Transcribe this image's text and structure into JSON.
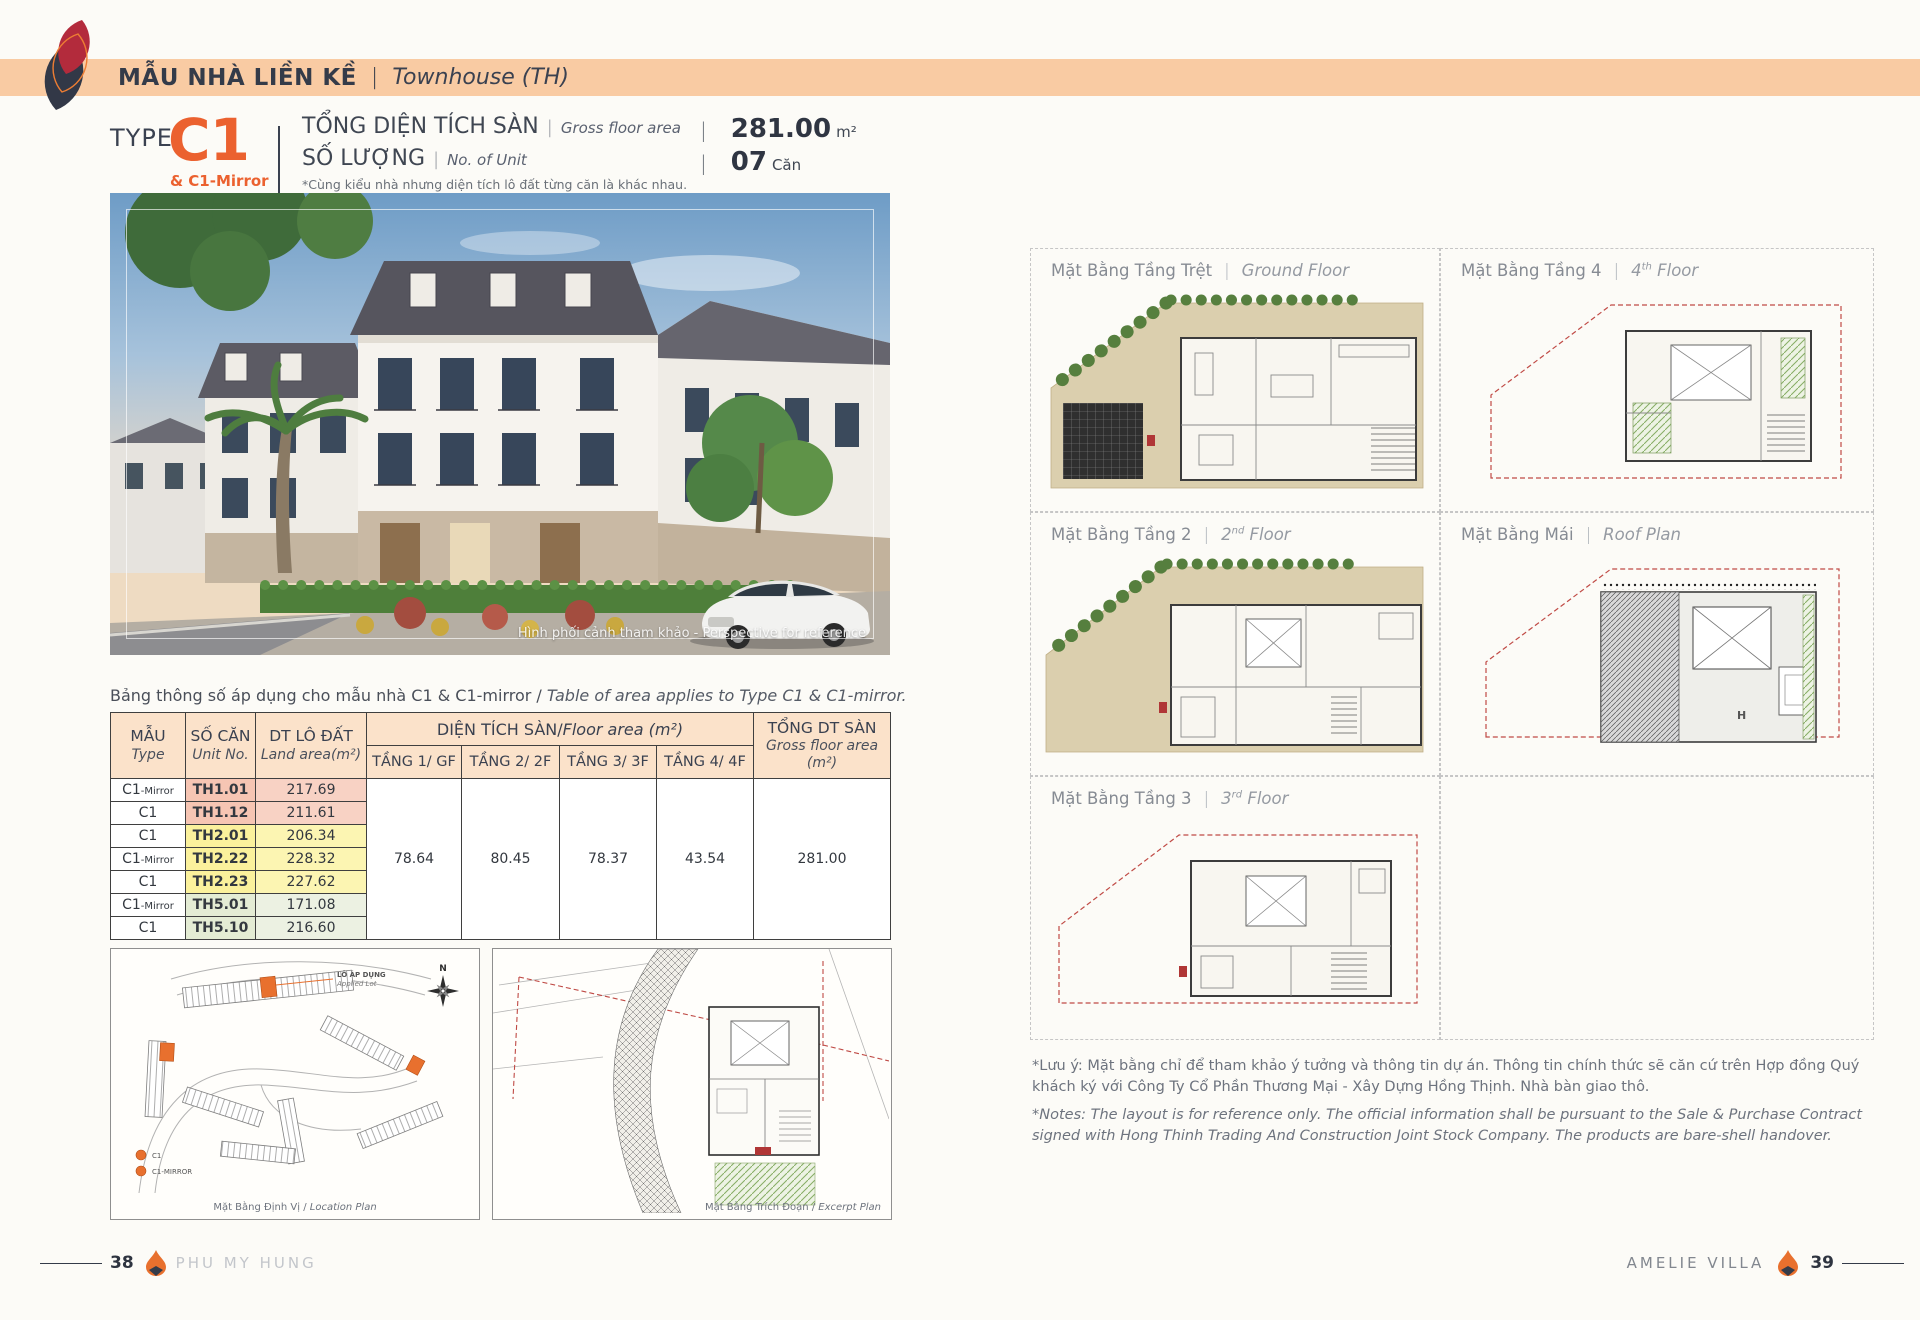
{
  "page": {
    "accent_orange": "#eb612f",
    "band_color": "#f9cba3",
    "dark_navy": "#343b49",
    "logo_red": "#b32b3c",
    "table_row_colors": {
      "pink": "#f6c5b3",
      "yellow": "#fbf19c",
      "green": "#e4ecd4"
    }
  },
  "header": {
    "title_vi": "MẪU NHÀ LIỀN KỀ",
    "sep": "|",
    "title_en": "Townhouse (TH)"
  },
  "spec": {
    "type_label": "TYPE",
    "type_code": "C1",
    "type_sub": "& C1-Mirror",
    "sep": "|",
    "gfa_vi": "TỔNG DIỆN TÍCH SÀN",
    "gfa_en": "Gross floor area",
    "gfa_value": "281.00",
    "gfa_unit": "m²",
    "qty_vi": "SỐ LƯỢNG",
    "qty_en": "No. of Unit",
    "qty_value": "07",
    "qty_unit": "Căn",
    "note_vi": "*Cùng kiểu nhà nhưng diện tích lô đất từng căn là khác nhau.",
    "note_en": "The land area is subject to change in the same house type."
  },
  "photo": {
    "caption": "Hình phối cảnh tham khảo - Perspective for reference"
  },
  "area_table": {
    "caption_vi": "Bảng thông số áp dụng cho mẫu nhà C1 & C1-mirror /",
    "caption_en": " Table of area applies to Type C1 & C1-mirror.",
    "col_type_vi": "MẪU",
    "col_type_en": "Type",
    "col_unit_vi": "SỐ CĂN",
    "col_unit_en": "Unit No.",
    "col_land_vi": "DT LÔ ĐẤT",
    "col_land_en": "Land area(m²)",
    "col_floor_group_vi": "DIỆN TÍCH SÀN/",
    "col_floor_group_en": "Floor area (m²)",
    "col_floors": [
      "TẦNG 1/ GF",
      "TẦNG 2/ 2F",
      "TẦNG 3/ 3F",
      "TẦNG 4/ 4F"
    ],
    "col_total_vi": "TỔNG DT SÀN",
    "col_total_en": "Gross floor area",
    "col_total_unit": "(m²)",
    "rows": [
      {
        "type": "C1",
        "type_suffix": "-Mirror",
        "unit": "TH1.01",
        "land": "217.69"
      },
      {
        "type": "C1",
        "type_suffix": "",
        "unit": "TH1.12",
        "land": "211.61"
      },
      {
        "type": "C1",
        "type_suffix": "",
        "unit": "TH2.01",
        "land": "206.34"
      },
      {
        "type": "C1",
        "type_suffix": "-Mirror",
        "unit": "TH2.22",
        "land": "228.32"
      },
      {
        "type": "C1",
        "type_suffix": "",
        "unit": "TH2.23",
        "land": "227.62"
      },
      {
        "type": "C1",
        "type_suffix": "-Mirror",
        "unit": "TH5.01",
        "land": "171.08"
      },
      {
        "type": "C1",
        "type_suffix": "",
        "unit": "TH5.10",
        "land": "216.60"
      }
    ],
    "floor_values": [
      "78.64",
      "80.45",
      "78.37",
      "43.54"
    ],
    "total_value": "281.00"
  },
  "site_plans": {
    "location": {
      "caption_vi": "Mặt Bằng Định Vị /",
      "caption_en": " Location Plan",
      "applied_lot_vi": "LÔ ÁP DỤNG",
      "applied_lot_en": "Applied Lot",
      "compass": "N",
      "legend": [
        {
          "label": "C1"
        },
        {
          "label": "C1-MIRROR"
        }
      ]
    },
    "excerpt": {
      "caption_vi": "Mặt Bằng Trích Đoạn /",
      "caption_en": " Excerpt Plan"
    }
  },
  "floor_plans": {
    "sep": "|",
    "items": [
      {
        "vi": "Mặt Bằng Tầng Trệt",
        "en_pre": "Ground Floor",
        "en_sup": "",
        "en_post": ""
      },
      {
        "vi": "Mặt Bằng Tầng 4",
        "en_pre": "4",
        "en_sup": "th",
        "en_post": " Floor"
      },
      {
        "vi": "Mặt Bằng Tầng 2",
        "en_pre": "2",
        "en_sup": "nd",
        "en_post": " Floor"
      },
      {
        "vi": "Mặt Bằng Mái",
        "en_pre": "Roof Plan",
        "en_sup": "",
        "en_post": ""
      },
      {
        "vi": "Mặt Bằng Tầng 3",
        "en_pre": "3",
        "en_sup": "rd",
        "en_post": " Floor"
      }
    ]
  },
  "notes": {
    "vi": "*Lưu ý: Mặt bằng chỉ để tham khảo ý tưởng và thông tin dự án. Thông tin chính thức sẽ căn cứ trên Hợp đồng Quý khách ký với Công Ty Cổ Phần Thương Mại - Xây Dựng Hồng Thịnh. Nhà bàn giao thô.",
    "en": "*Notes: The layout is for reference only. The official information shall be pursuant to the Sale & Purchase Contract signed with Hong Thinh Trading And Construction Joint Stock Company. The products are bare-shell handover."
  },
  "footer": {
    "page_left": "38",
    "brand_left": "PHU MY HUNG",
    "brand_right": "AMELIE VILLA",
    "page_right": "39"
  }
}
